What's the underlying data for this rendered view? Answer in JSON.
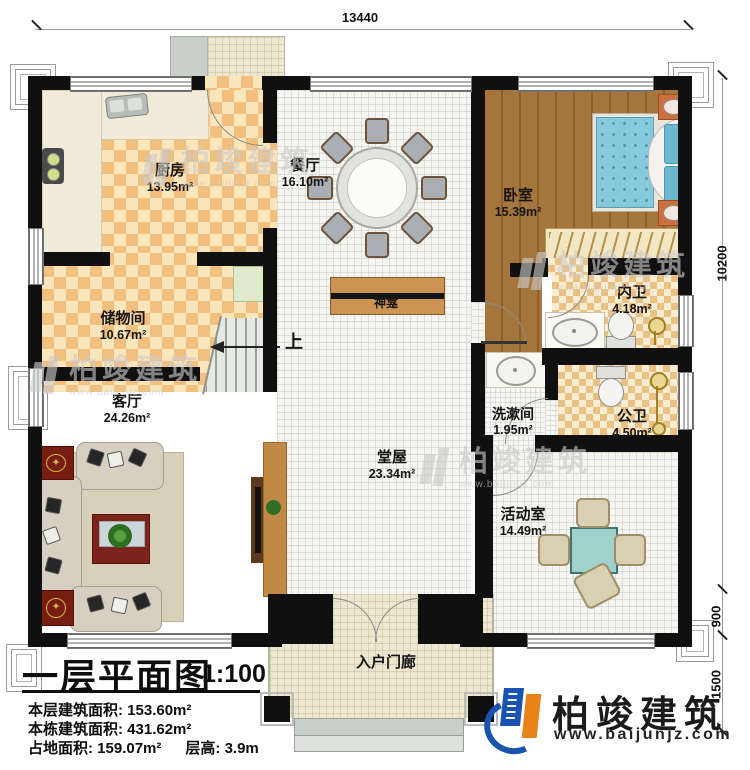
{
  "dims": {
    "top": "13440",
    "right_total": "10200",
    "right_offset": "900",
    "right_porch": "1500"
  },
  "rooms": {
    "kitchen": {
      "name": "厨房",
      "area": "13.95m²"
    },
    "dining": {
      "name": "餐厅",
      "area": "16.10m²"
    },
    "bedroom": {
      "name": "卧室",
      "area": "15.39m²"
    },
    "storage": {
      "name": "储物间",
      "area": "10.67m²"
    },
    "living": {
      "name": "客厅",
      "area": "24.26m²"
    },
    "inner_bath": {
      "name": "内卫",
      "area": "4.18m²"
    },
    "washroom": {
      "name": "洗漱间",
      "area": "1.95m²"
    },
    "public_bath": {
      "name": "公卫",
      "area": "4.50m²"
    },
    "hall": {
      "name": "堂屋",
      "area": "23.34m²"
    },
    "activity": {
      "name": "活动室",
      "area": "14.49m²"
    }
  },
  "labels": {
    "shrine": "神龛",
    "stairs_up": "上",
    "porch": "入户门廊"
  },
  "title_block": {
    "title": "一层平面图",
    "scale": "1:100",
    "stat1_label": "本层建筑面积:",
    "stat1_value": "153.60m²",
    "stat2_label": "本栋建筑面积:",
    "stat2_value": "431.62m²",
    "stat3_label": "占地面积:",
    "stat3_value": "159.07m²",
    "stat4_label": "层高:",
    "stat4_value": "3.9m"
  },
  "brand": {
    "name": "柏竣建筑",
    "site": "www.baijunjz.com"
  },
  "watermark": {
    "text": "柏竣建筑",
    "site": "www.baijunjz.com"
  }
}
